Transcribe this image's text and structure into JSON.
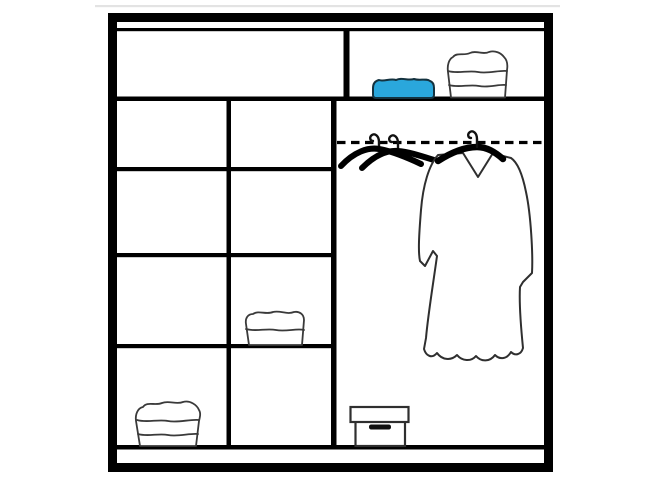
{
  "diagram": {
    "type": "wardrobe-interior-layout",
    "colors": {
      "background": "#ffffff",
      "line": "#000000",
      "item_outline": "#2f2f2f",
      "item_fill": "#ffffff",
      "accent_blue": "#2aa7dc",
      "top_edge_shadow": "#e3e3e3"
    },
    "structure": {
      "top_row": [
        "empty wide shelf",
        "shelf with folded blue garment and white towel stack"
      ],
      "left_shelf_columns": 2,
      "left_shelf_rows": 4,
      "right_section": "hanging rail section with dashed rail line"
    },
    "items": [
      {
        "name": "folded-blue-garment",
        "location": "top-right-shelf"
      },
      {
        "name": "folded-towel-stack-3-layers",
        "location": "top-right-shelf"
      },
      {
        "name": "crossed-black-hangers",
        "location": "hanging-rail"
      },
      {
        "name": "hanging-robe-on-hanger",
        "location": "hanging-rail"
      },
      {
        "name": "folded-towel-2-layers",
        "location": "middle-column-third-shelf"
      },
      {
        "name": "folded-towel-stack-3-layers",
        "location": "left-column-bottom-shelf"
      },
      {
        "name": "storage-box-with-lid",
        "location": "hanging-section-floor"
      }
    ]
  }
}
